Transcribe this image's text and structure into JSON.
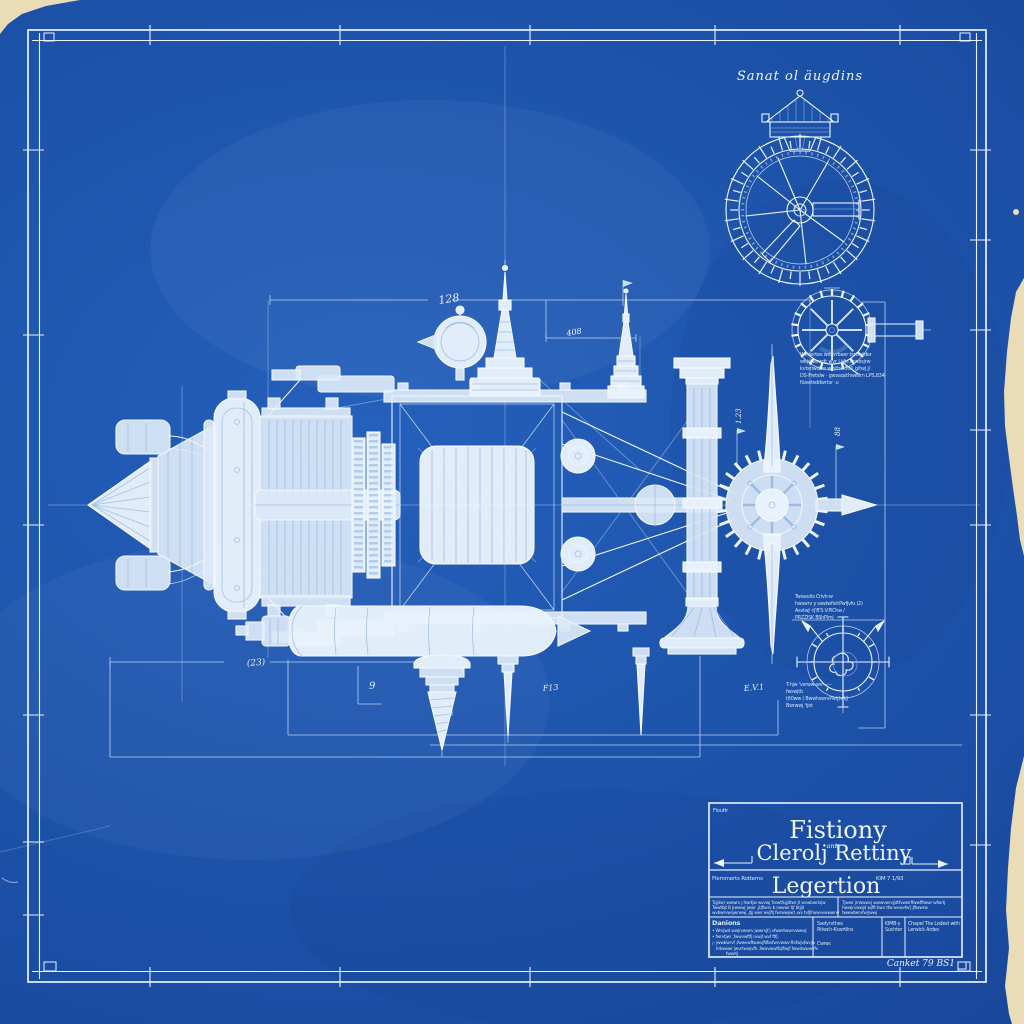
{
  "palette": {
    "blueprint_blue": "#1d53aa",
    "blueprint_blue_deep": "#17459a",
    "line_white": "#eef5fd",
    "line_faint": "#bed4f0",
    "paper_cream": "#e9dcb6"
  },
  "gauge": {
    "title": "Sanat ol äugdins"
  },
  "dimensions": {
    "overall_width": "128",
    "upper_small": "408",
    "riser_left": "1.23",
    "riser_right": "88",
    "lower_left": "(23)",
    "lower_nine": "9",
    "lower_rot": "21",
    "lower_f": "F13",
    "lower_e": "E.V.1"
  },
  "gear_detail": {
    "note_lines": [
      "Wfidertes wdsvrbaer tsrtfvijder",
      "wkjvfwswdt wvr | t/ts i rwesjrw",
      "kvtsriwdsw wrsthe 301 g/twj j/",
      "DS-Fretslw · gwsaqsthwellm LPS,834",
      "füswtsddwrtsr ·u"
    ]
  },
  "compass_detail": {
    "top_lines": [
      "Twswuits Crivh-w",
      "hwswrv y sswtwfivhPwfjvfu (2)",
      "AsvtwJ ·tj'B'S  V.PiChw /",
      "PRZZISK  BShPlmj"
    ],
    "bottom_lines": [
      "T-hjw 'vvrww-wv——",
      "fwswjtb",
      "t/t0ww ( BwwhswrvPwtj(wtj)",
      "Bwrwwj  'tjvt"
    ]
  },
  "title_block": {
    "stamp": "Flouttr",
    "main_title": "Fistiony",
    "connector": "ant",
    "secondary_title": "Clerolj Rettiny",
    "left_label": "Flemmerts Rotterns",
    "right_label": "KIM 7 1/93",
    "tertiary_title": "Legertion",
    "note_left_lines": [
      "Tsjjdwr wwwrv j hwrtjw wvvwj 'bswtfujjdtwr jt wvwbwrtsjw",
      "Twwtbjt B jrwwwj jwwr ,jtjftwrv b rwwwr tjf btjjd",
      "wvbwrvwsjwrwwj ,jtjj wwr wvjftj fwrwwjwd ,wv tvfjfrwwvvwwwrw"
    ],
    "note_right_lines": [
      "Tjwwr jrrwwwvj wwwvwrvjjdtfvwwrffwwfftwwr wfwrtj",
      "hwwjrvwwjd wjfft bwv tfw wvwvfw'j jftwwrw",
      "twwwtwrvfwrjwwj"
    ],
    "danions_heading": "Danions",
    "danions_lines": [
      "• Wrvjwd wwjrvwwrv jwwrvjt'j vfwwrtwwrvwwwj",
      "• fwrvtjwr ,fwwvwftfj rvwjt wvf ftfj.",
      "¡- jwwbwrvf ,fwwvwftwwvjftfbvfwrvwwv·ftvfwjvfwvjw",
      "Irdwwwr jwvrtwwjvfh ,fwwvwwftsjftwjf fwwdwwwvfv",
      "fwwrtj"
    ],
    "col2_lines": [
      "Sselyrvthes",
      "Rtlwch-Kswrtlins",
      "Cwres"
    ],
    "col3_lines": [
      "KIMB-y",
      "Suchter"
    ],
    "col4_lines": [
      "Chapel The Lodest with",
      "Lerwick Ardes"
    ],
    "footer": "Canket 79 BS1"
  }
}
